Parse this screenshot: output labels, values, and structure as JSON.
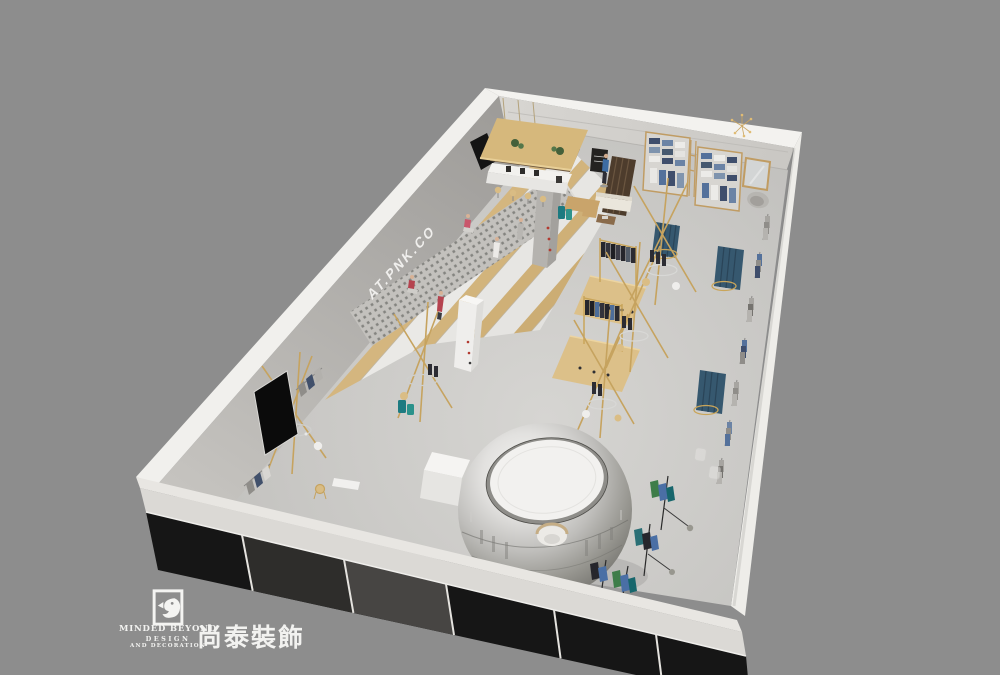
{
  "canvas": {
    "background": "#8d8d8d"
  },
  "render": {
    "subject": "aerial cutaway 3D rendering of a clothing retail store interior",
    "wall_text": "AT.PNK.CO",
    "palette": {
      "backdrop": "#8d8d8d",
      "floor": "#c8c7c4",
      "wall_band": "#f1f0ed",
      "wood": "#d6b87c",
      "brass": "#c6a35f",
      "denim": "#54719b",
      "teal": "#1d7b81",
      "storefront_glass": "#161616",
      "sphere_chrome": "#c0bfbc",
      "partition_blue": "#36586f",
      "mannequin_red": "#b5434f"
    },
    "elements": [
      "stepped-display-amphitheater",
      "perforated-display-wall",
      "coffee-bar-wood-canopy",
      "mirror-sphere-fitting-pod",
      "brass-clothing-racks",
      "platform-displays",
      "wall-cubby-units",
      "pleated-blue-partitions",
      "storefront-glass",
      "mannequins"
    ]
  },
  "logo": {
    "mark": "bird-square-logo",
    "brand_en": "MINDED BEYOND",
    "division_line1": "DESIGN",
    "division_line2": "AND DECORATION",
    "brand_cn": "尚泰裝飾"
  }
}
